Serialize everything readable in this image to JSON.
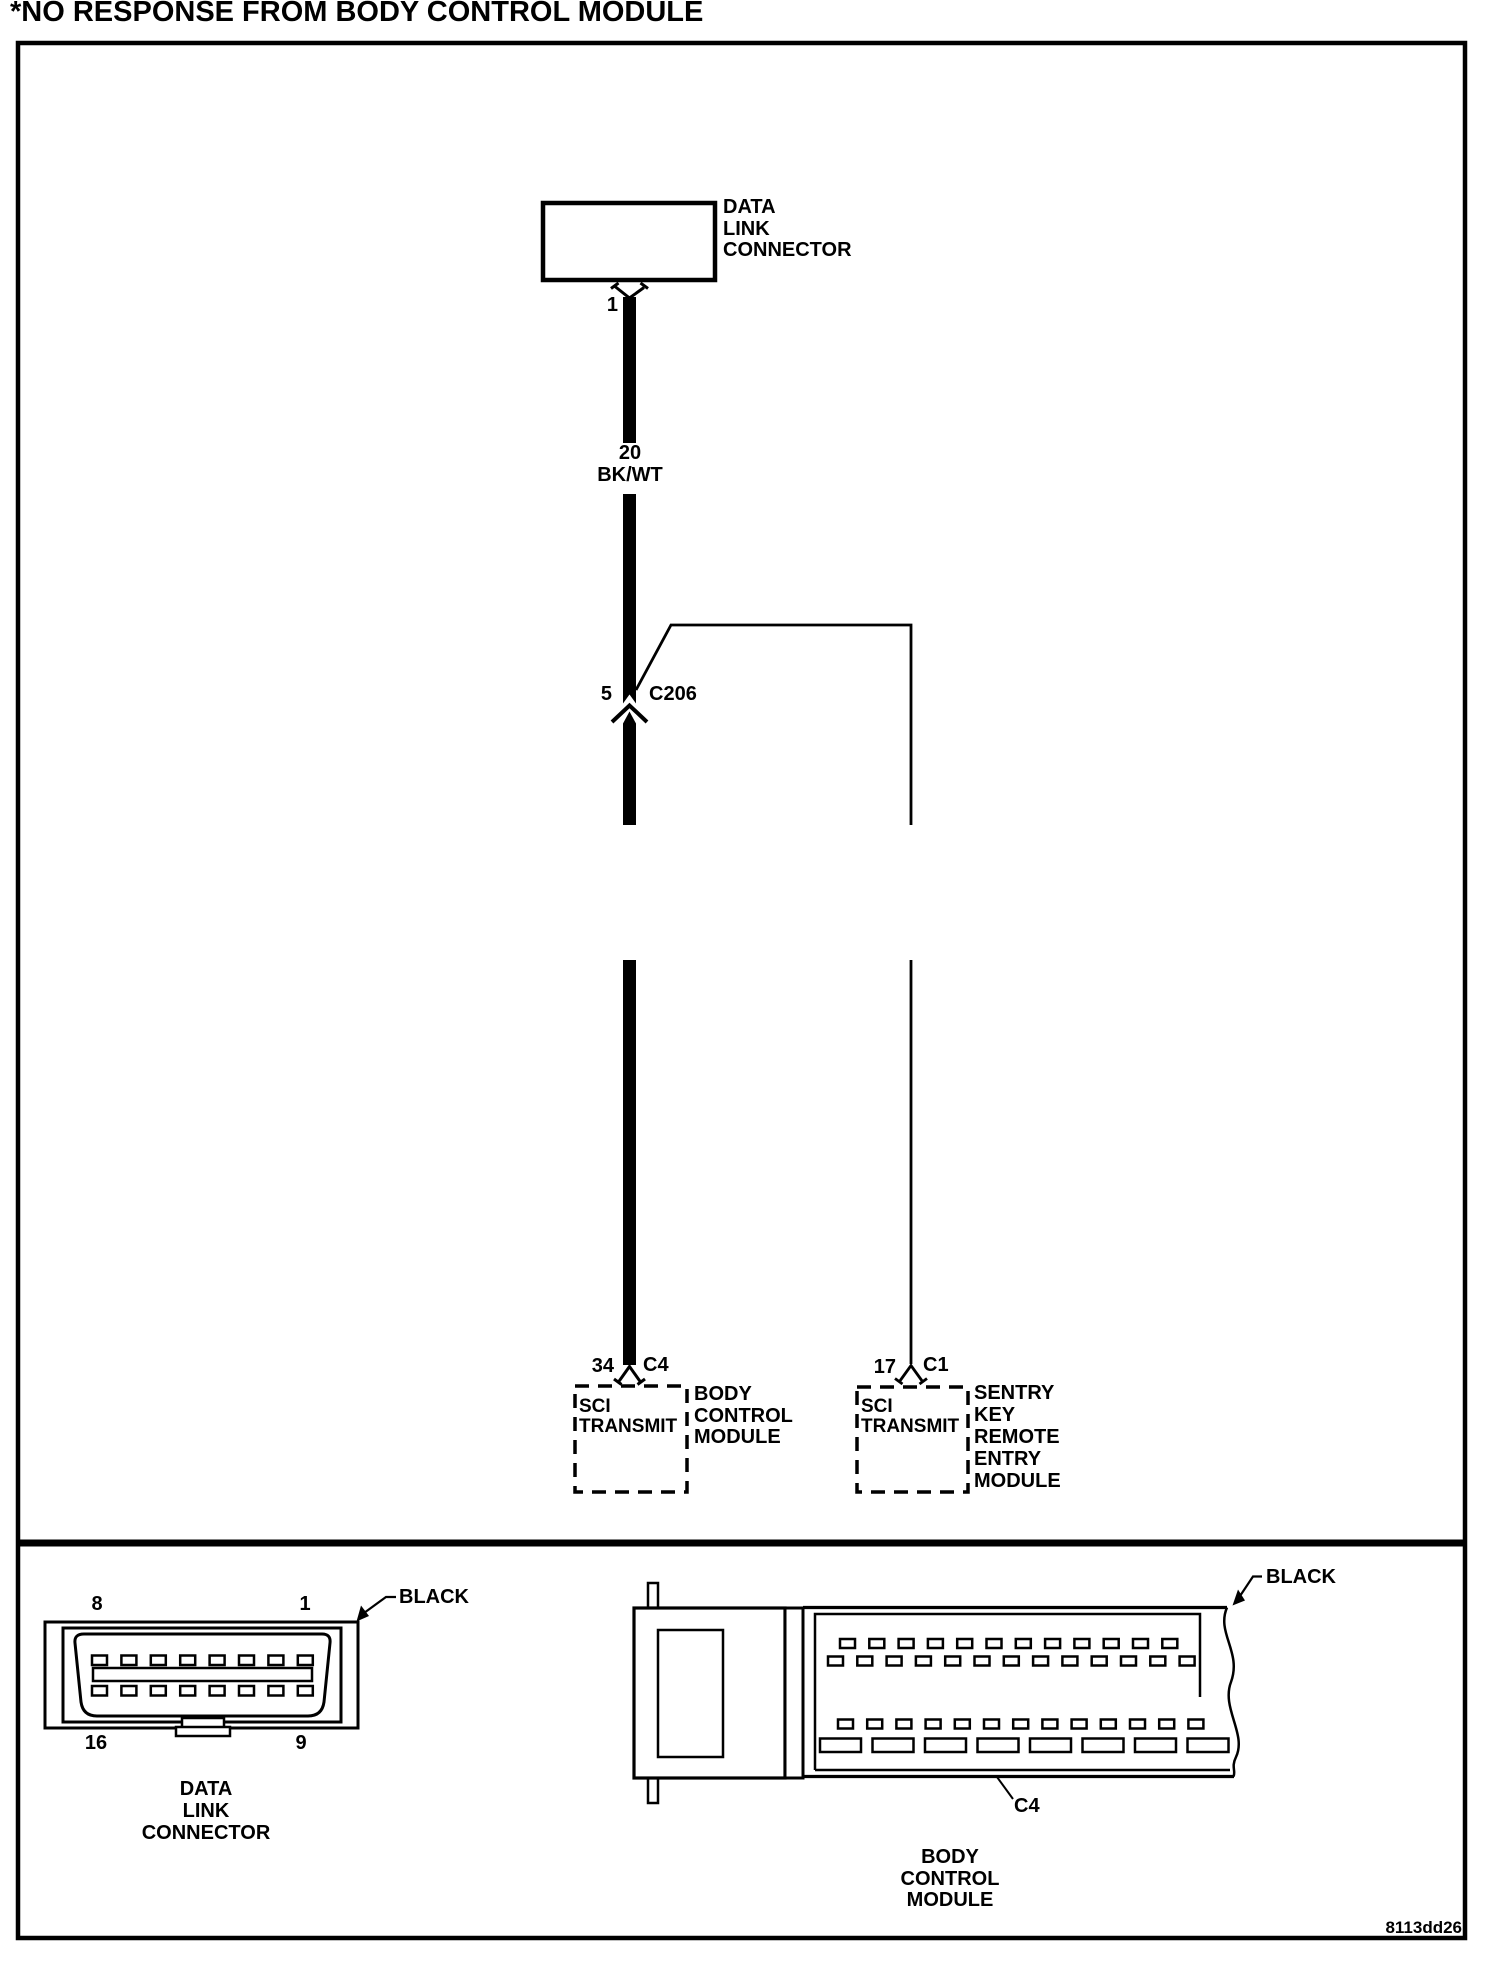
{
  "title": "*NO RESPONSE FROM BODY CONTROL MODULE",
  "figure_id": "8113dd26",
  "colors": {
    "ink": "#000000",
    "paper": "#ffffff"
  },
  "schematic": {
    "data_link_connector": {
      "label": "DATA\nLINK\nCONNECTOR",
      "pin": "1"
    },
    "wire": {
      "gauge": "20",
      "color_code": "BK/WT"
    },
    "inline_connector": {
      "pin": "5",
      "name": "C206"
    },
    "body_control_module": {
      "pin": "34",
      "connector": "C4",
      "function_label": "SCI\nTRANSMIT",
      "module_label": "BODY\nCONTROL\nMODULE"
    },
    "sentry_key_module": {
      "pin": "17",
      "connector": "C1",
      "function_label": "SCI\nTRANSMIT",
      "module_label": "SENTRY\nKEY\nREMOTE\nENTRY\nMODULE"
    }
  },
  "connector_views": {
    "dlc": {
      "pin_top_left": "8",
      "pin_top_right": "1",
      "pin_bottom_left": "16",
      "pin_bottom_right": "9",
      "color": "BLACK",
      "caption": "DATA\nLINK\nCONNECTOR"
    },
    "bcm": {
      "color": "BLACK",
      "connector_label": "C4",
      "caption": "BODY\nCONTROL\nMODULE"
    }
  }
}
